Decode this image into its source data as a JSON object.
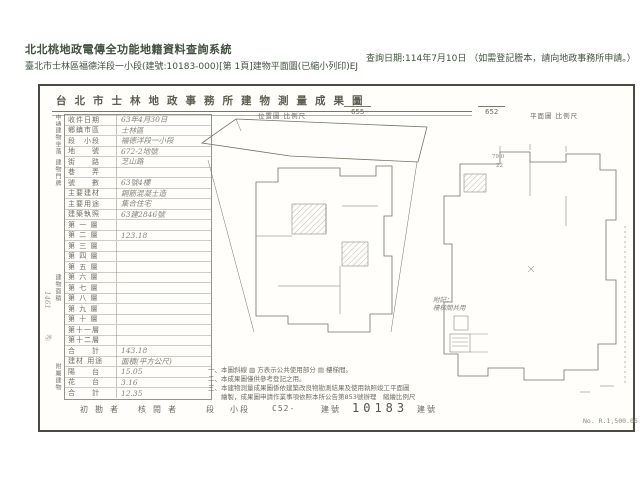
{
  "header": {
    "system_title": "北北桃地政電傳全功能地籍資料查詢系統",
    "document_line": "臺北市士林區福德洋段一小段(建號:10183-000)[第 1頁]建物平面圖(已縮小列印)EJ",
    "query_date": "查詢日期:114年7月10日 （如需登記謄本，請向地政事務所申請。）"
  },
  "document": {
    "title": "台北市士林地政事務所建物測量成果圖",
    "location_scale_caption": "位置圖 比例尺",
    "location_parcel_no": "655",
    "plan_scale_value": "652",
    "plan_scale_caption": "平面圖 比例尺",
    "group_labels": [
      "申請人",
      "建物坐落",
      "建物門牌",
      "建物面積",
      "附屬建物"
    ],
    "form_rows": [
      {
        "l": "收件日期",
        "v": "63年4月30日"
      },
      {
        "l": "鄉鎮市區",
        "v": "士林區"
      },
      {
        "l": "段　小段",
        "v": "福德洋段一小段"
      },
      {
        "l": "地　　號",
        "v": "672-2地號"
      },
      {
        "l": "街　　路",
        "v": "芝山路"
      },
      {
        "l": "巷　　弄",
        "v": ""
      },
      {
        "l": "號　　數",
        "v": "63號4樓"
      },
      {
        "l": "主要建材",
        "v": "鋼筋混凝土造"
      },
      {
        "l": "主要用途",
        "v": "集合住宅"
      },
      {
        "l": "建築執照",
        "v": "63建2846號"
      },
      {
        "l": "第 一 層",
        "v": ""
      },
      {
        "l": "第 二 層",
        "v": "123.18"
      },
      {
        "l": "第 三 層",
        "v": ""
      },
      {
        "l": "第 四 層",
        "v": ""
      },
      {
        "l": "第 五 層",
        "v": ""
      },
      {
        "l": "第 六 層",
        "v": ""
      },
      {
        "l": "第 七 層",
        "v": ""
      },
      {
        "l": "第 八 層",
        "v": ""
      },
      {
        "l": "第 九 層",
        "v": ""
      },
      {
        "l": "第 十 層",
        "v": ""
      },
      {
        "l": "第十一層",
        "v": ""
      },
      {
        "l": "第十二層",
        "v": ""
      },
      {
        "l": "合　　計",
        "v": "143.18"
      },
      {
        "l": "建材 用途",
        "v": "面積(平方公尺)"
      },
      {
        "l": "陽　　台",
        "v": "15.05"
      },
      {
        "l": "花　　台",
        "v": "3.16"
      },
      {
        "l": "合　　計",
        "v": "12.35"
      }
    ],
    "margin_notes": [
      "1461",
      "㉙"
    ],
    "plan_annotations": {
      "dim1": "79.0",
      "dim2": "22",
      "annex_label": "附記：",
      "annex_value": "樓梯間共用"
    },
    "notes": [
      "一、本圖斜線 ▨ 方表示公共使用部分 ▤ 樓梯間。",
      "二、本成果圖僅供參考登記之用。",
      "三、本建物測量成果圖係依建築改良物勘測結果及使用執照竣工平面圖",
      "　　繪製，成果圖申請作業事項依照本所公告第853號辦理　縮繪比例尺"
    ],
    "footer": {
      "items": [
        "初勘者",
        "核閱者",
        "段",
        "小段",
        "C52-",
        "建號",
        "10183",
        "建號"
      ],
      "form_no": "No. R.1,500.06"
    }
  }
}
